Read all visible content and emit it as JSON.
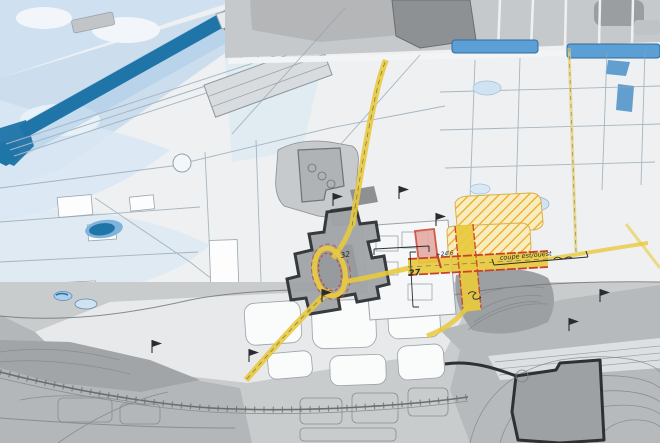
{
  "map": {
    "kind": "hand-drawn urban site plan sketch",
    "annotations": {
      "site_number": "32",
      "path_dimension": "27",
      "spot_level": "+24'6",
      "section_label": "coupe est/ouest"
    }
  },
  "colors": {
    "paper": "#eef0f1",
    "water-dark": "#1f74a8",
    "water-mid": "#5b9fd4",
    "water-light": "#aecfe9",
    "wash-pale": "#d9e7f4",
    "block-gray": "#c6c9cb",
    "block-dark": "#8e9193",
    "terrain-gray": "#c9cccd",
    "terrain-dark": "#a8abad",
    "site-fill": "#a2a5a8",
    "site-outline": "#2e3134",
    "path-yellow": "#e8c93e",
    "hatch-orange": "#efa51f",
    "hatch-bg": "#f8edbe",
    "accent-red": "#c8402e",
    "red-building": "#e5a79e",
    "ink": "#2a2d30",
    "sketch-line": "#8fa3b2"
  }
}
